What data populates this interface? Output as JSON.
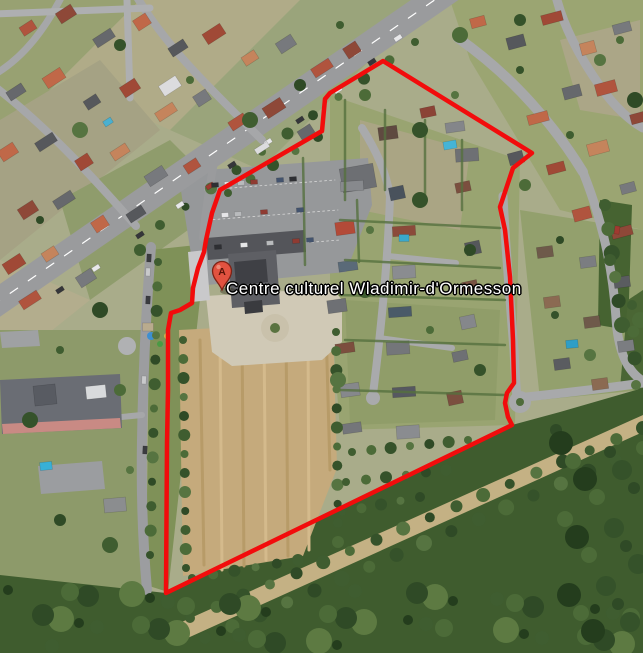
{
  "map": {
    "place_label": "Centre culturel Wladimir-d'Ormesson",
    "marker": {
      "letter": "A",
      "transform": "translate(222,276)",
      "color": "#e25240"
    },
    "overlay": {
      "stroke_color": "#f20c0c",
      "polygon_points": "383,61 532,153 513,168 500,207 505,230 510,277 513,340 514,383 507,393 505,403 508,417 512,425 166,593 167,443 168,390 168,330 171,313 180,310 192,303 193,288 198,268 204,252 206,240 212,213 220,190 322,131 325,99 330,93"
    }
  }
}
